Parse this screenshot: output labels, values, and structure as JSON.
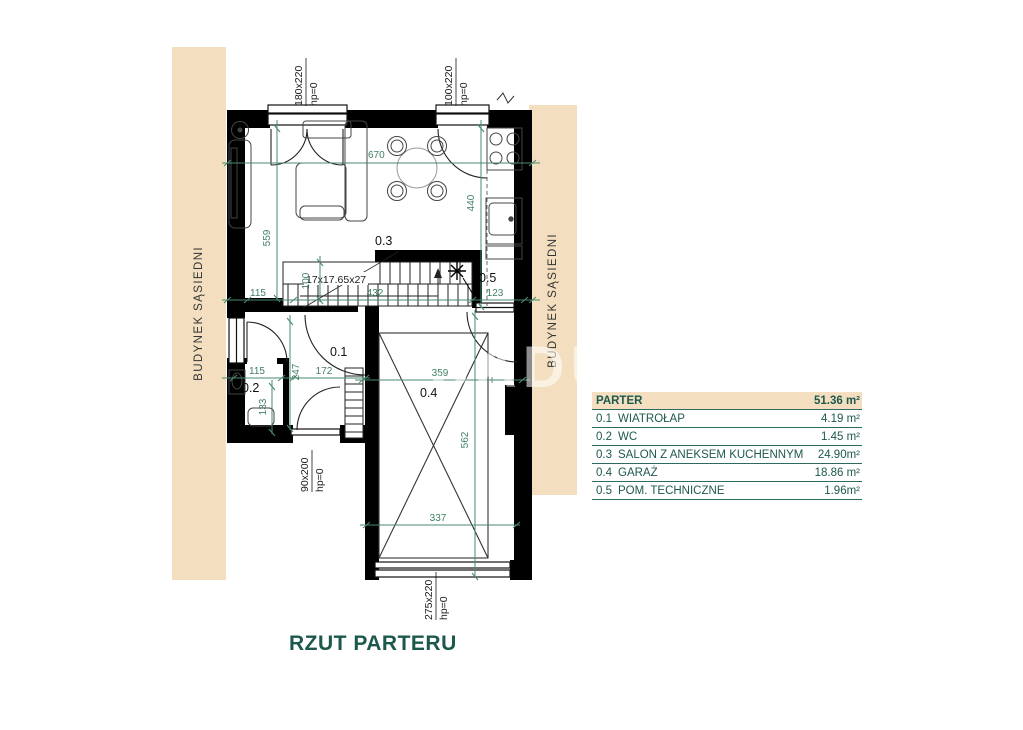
{
  "plan": {
    "title": "RZUT PARTERU",
    "neighbor_left": "BUDYNEK SĄSIEDNI",
    "neighbor_right": "BUDYNEK SĄSIEDNI",
    "watermark": "SADU",
    "rooms": {
      "r01": "0.1",
      "r02": "0.2",
      "r03": "0.3",
      "r04": "0.4",
      "r05": "0.5"
    },
    "stairs_note": "17x17.65x27",
    "dims": {
      "d670": "670",
      "d559": "559",
      "d440": "440",
      "d115a": "115",
      "d100": "100",
      "d432": "432",
      "d123": "123",
      "d115b": "115",
      "d247": "247",
      "d172": "172",
      "d133": "133",
      "d359": "359",
      "d562": "562",
      "d337": "337"
    },
    "openings": {
      "w1": "180x220",
      "w1hp": "hp=0",
      "w2": "100x220",
      "w2hp": "hp=0",
      "door": "90x200",
      "doorhp": "hp=0",
      "garage": "275x220",
      "garagehp": "hp=0"
    }
  },
  "legend": {
    "header": {
      "label": "PARTER",
      "area": "51.36 m²"
    },
    "rows": [
      {
        "num": "0.1",
        "label": "WIATROŁAP",
        "area": "4.19 m²"
      },
      {
        "num": "0.2",
        "label": "WC",
        "area": "1.45 m²"
      },
      {
        "num": "0.3",
        "label": "SALON Z ANEKSEM KUCHENNYM",
        "area": "24.90m²"
      },
      {
        "num": "0.4",
        "label": "GARAŻ",
        "area": "18.86 m²"
      },
      {
        "num": "0.5",
        "label": "POM. TECHNICZNE",
        "area": "1.96m²"
      }
    ]
  },
  "colors": {
    "accent_beige": "#f3dfbf",
    "dim_green": "#4a8a6f",
    "text_teal": "#1d584d",
    "wall_black": "#000000"
  }
}
